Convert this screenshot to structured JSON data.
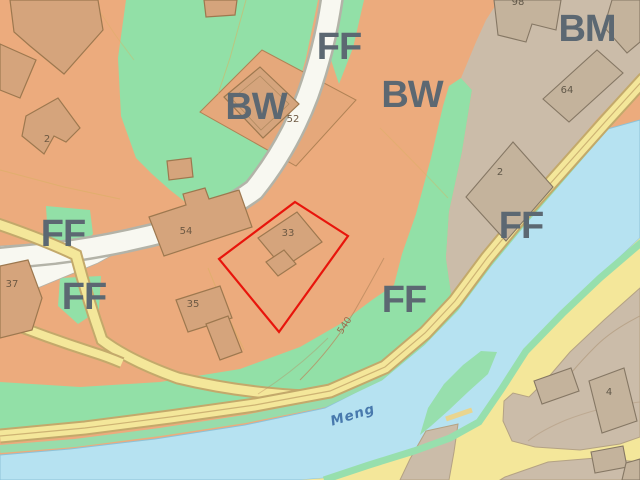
{
  "map": {
    "type": "cadastral-zoning-map",
    "zone_labels": [
      {
        "id": "ff-top",
        "text": "FF"
      },
      {
        "id": "bw-left",
        "text": "BW"
      },
      {
        "id": "bw-right",
        "text": "BW"
      },
      {
        "id": "bm-topright",
        "text": "BM"
      },
      {
        "id": "ff-left-upper",
        "text": "FF"
      },
      {
        "id": "ff-left-lower",
        "text": "FF"
      },
      {
        "id": "ff-right",
        "text": "FF"
      },
      {
        "id": "ff-riverside",
        "text": "FF"
      }
    ],
    "building_numbers": [
      {
        "id": "b2-left",
        "text": "2"
      },
      {
        "id": "b52",
        "text": "52"
      },
      {
        "id": "b54",
        "text": "54"
      },
      {
        "id": "b33-selected",
        "text": "33"
      },
      {
        "id": "b35",
        "text": "35"
      },
      {
        "id": "b37",
        "text": "37"
      },
      {
        "id": "b98-partial",
        "text": "98"
      },
      {
        "id": "b64",
        "text": "64"
      },
      {
        "id": "b2-right",
        "text": "2"
      },
      {
        "id": "b4",
        "text": "4"
      }
    ],
    "river_label": "Meng",
    "contour_label": "540",
    "colors": {
      "zone_orange": "#ecab7d",
      "zone_green": "#92e0a7",
      "zone_gray": "#cbbca9",
      "road_white": "#f8f8f1",
      "road_yellow": "#f4e79a",
      "river_blue": "#b6e2f1",
      "selection_red": "#e8150c",
      "zone_label_gray": "#5c6872"
    }
  }
}
